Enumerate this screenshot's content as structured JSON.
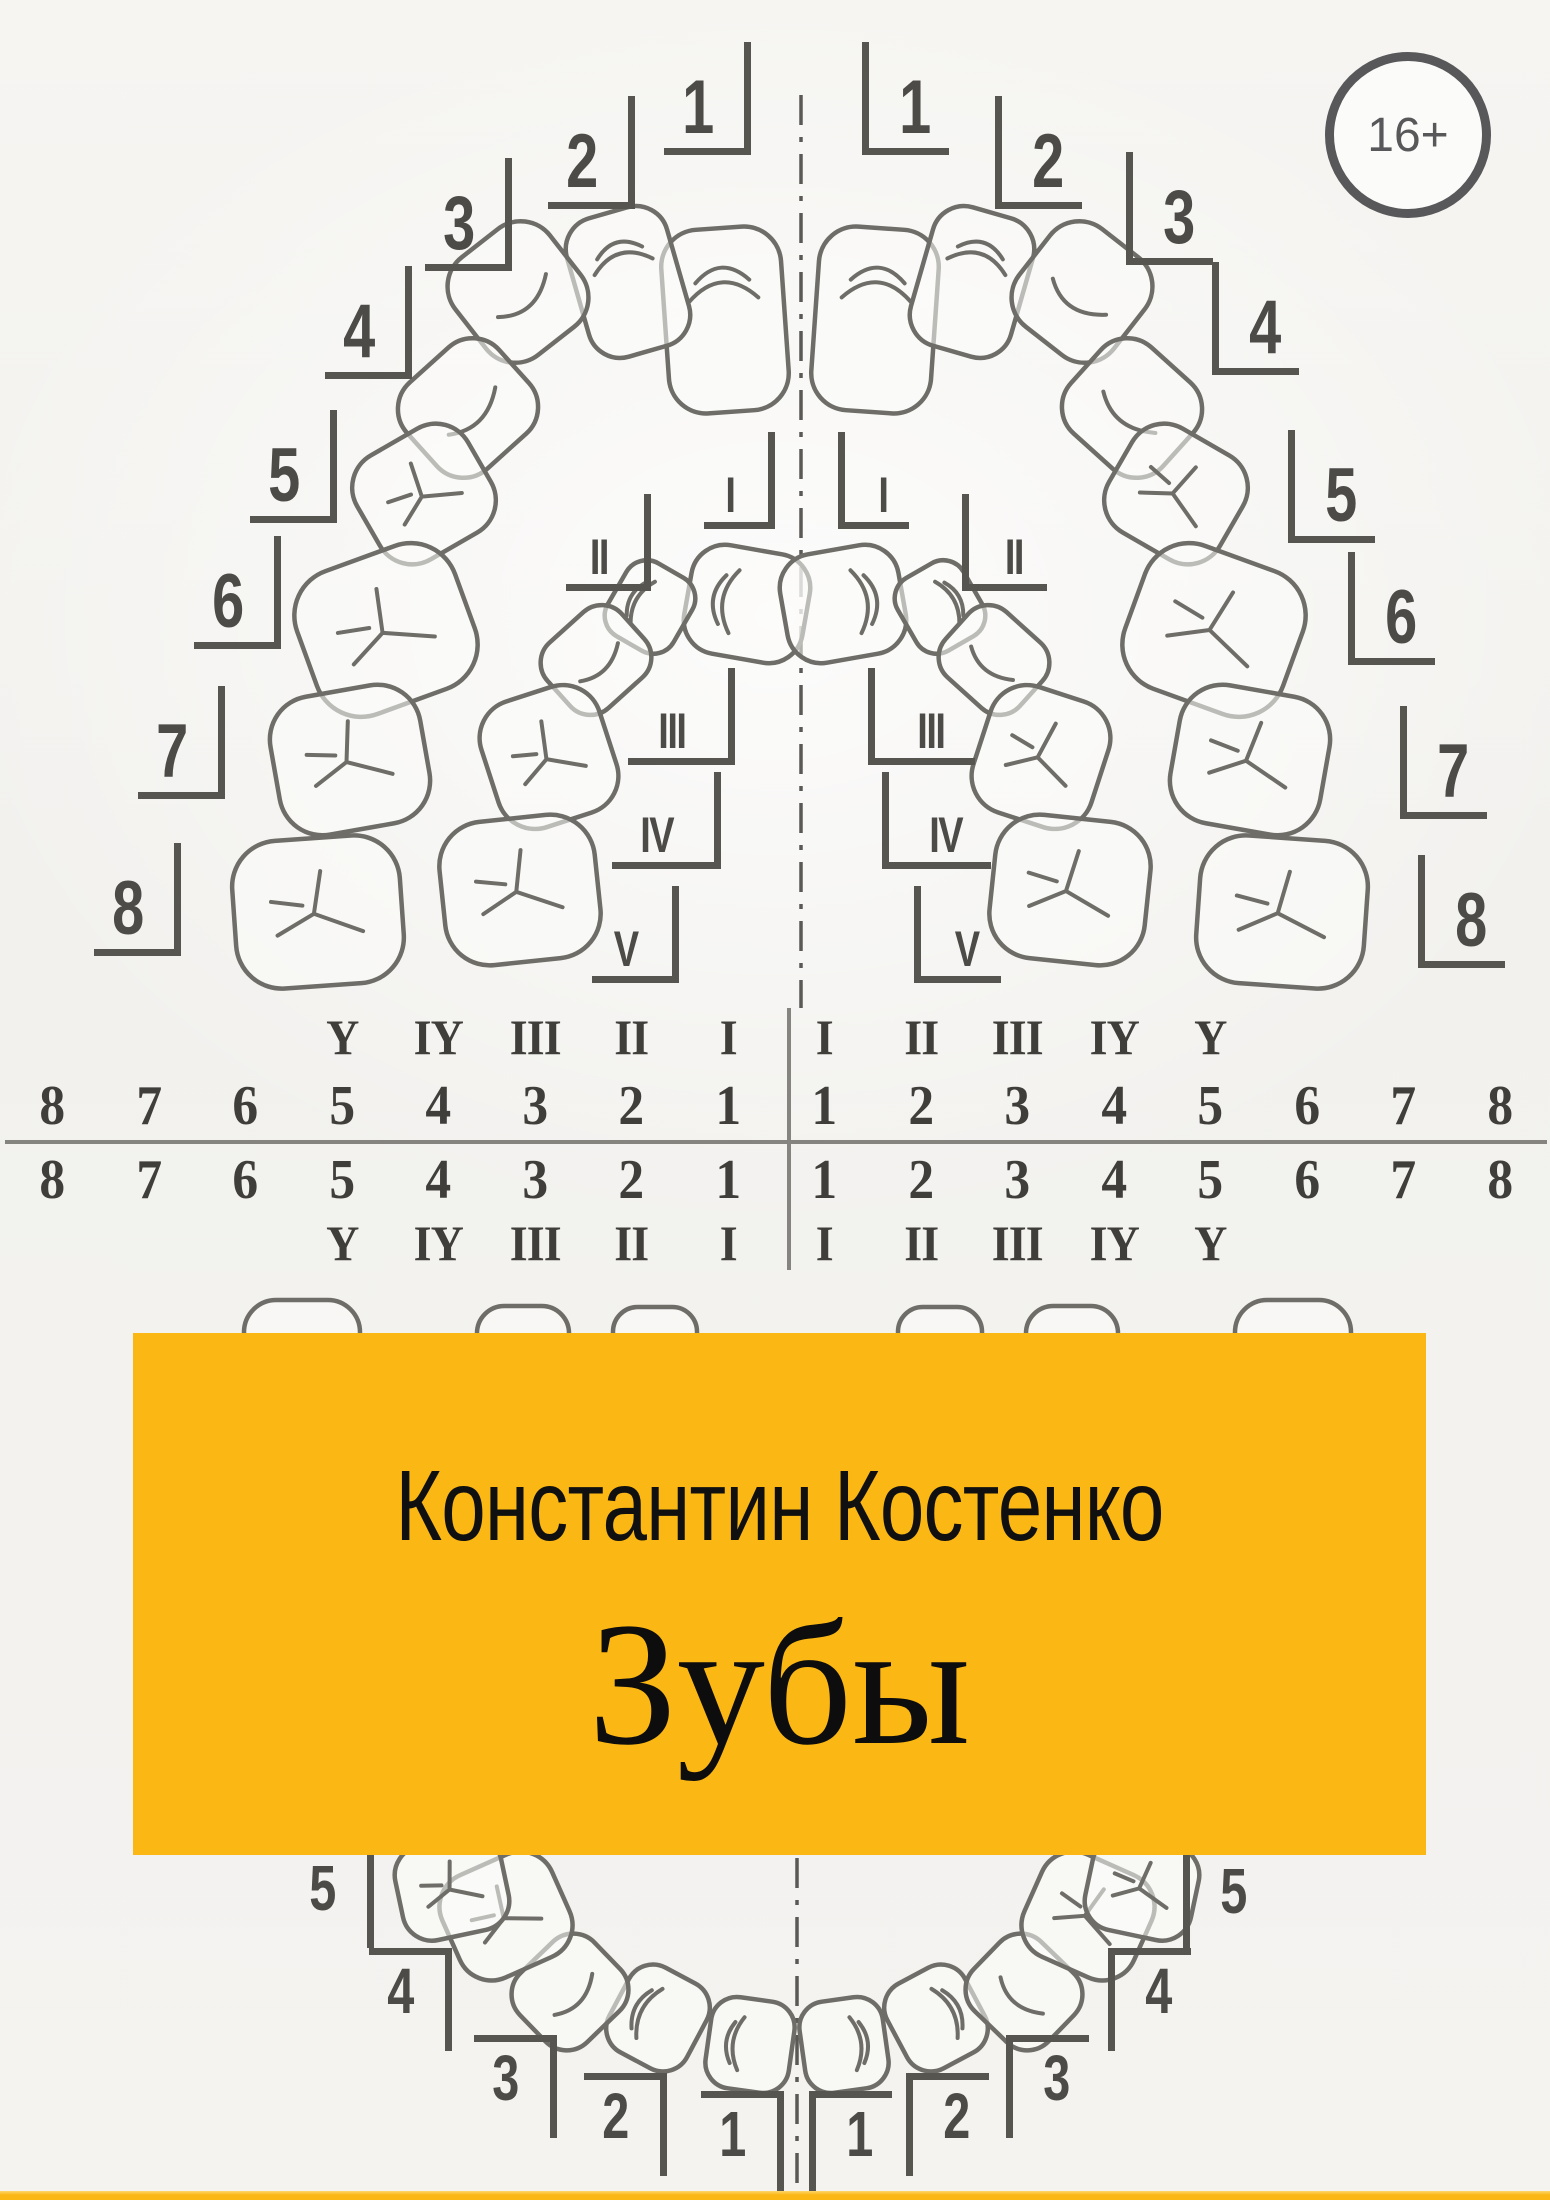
{
  "cover": {
    "age_rating": "16+",
    "author": "Константин Костенко",
    "title": "Зубы"
  },
  "notation_table": {
    "roman_row": [
      "Y",
      "IY",
      "III",
      "II",
      "I",
      "I",
      "II",
      "III",
      "IY",
      "Y"
    ],
    "digit_row": [
      "8",
      "7",
      "6",
      "5",
      "4",
      "3",
      "2",
      "1",
      "1",
      "2",
      "3",
      "4",
      "5",
      "6",
      "7",
      "8"
    ]
  },
  "upper_chart": {
    "permanent_left": [
      "1",
      "2",
      "3",
      "4",
      "5",
      "6",
      "7",
      "8"
    ],
    "permanent_right": [
      "1",
      "2",
      "3",
      "4",
      "5",
      "6",
      "7",
      "8"
    ],
    "deciduous_left": [
      "I",
      "II",
      "III",
      "IV",
      "V"
    ],
    "deciduous_right": [
      "I",
      "II",
      "III",
      "IV",
      "V"
    ]
  },
  "lower_chart": {
    "left": [
      "5",
      "4",
      "3",
      "2",
      "1"
    ],
    "right": [
      "1",
      "2",
      "3",
      "4",
      "5"
    ]
  },
  "colors": {
    "accent_yellow": "#FBB713",
    "ink_gray": "#4c4b48",
    "tooth_outline_gray": "#6e6d68",
    "table_line_gray": "#85847f",
    "badge_gray": "#58585a"
  }
}
